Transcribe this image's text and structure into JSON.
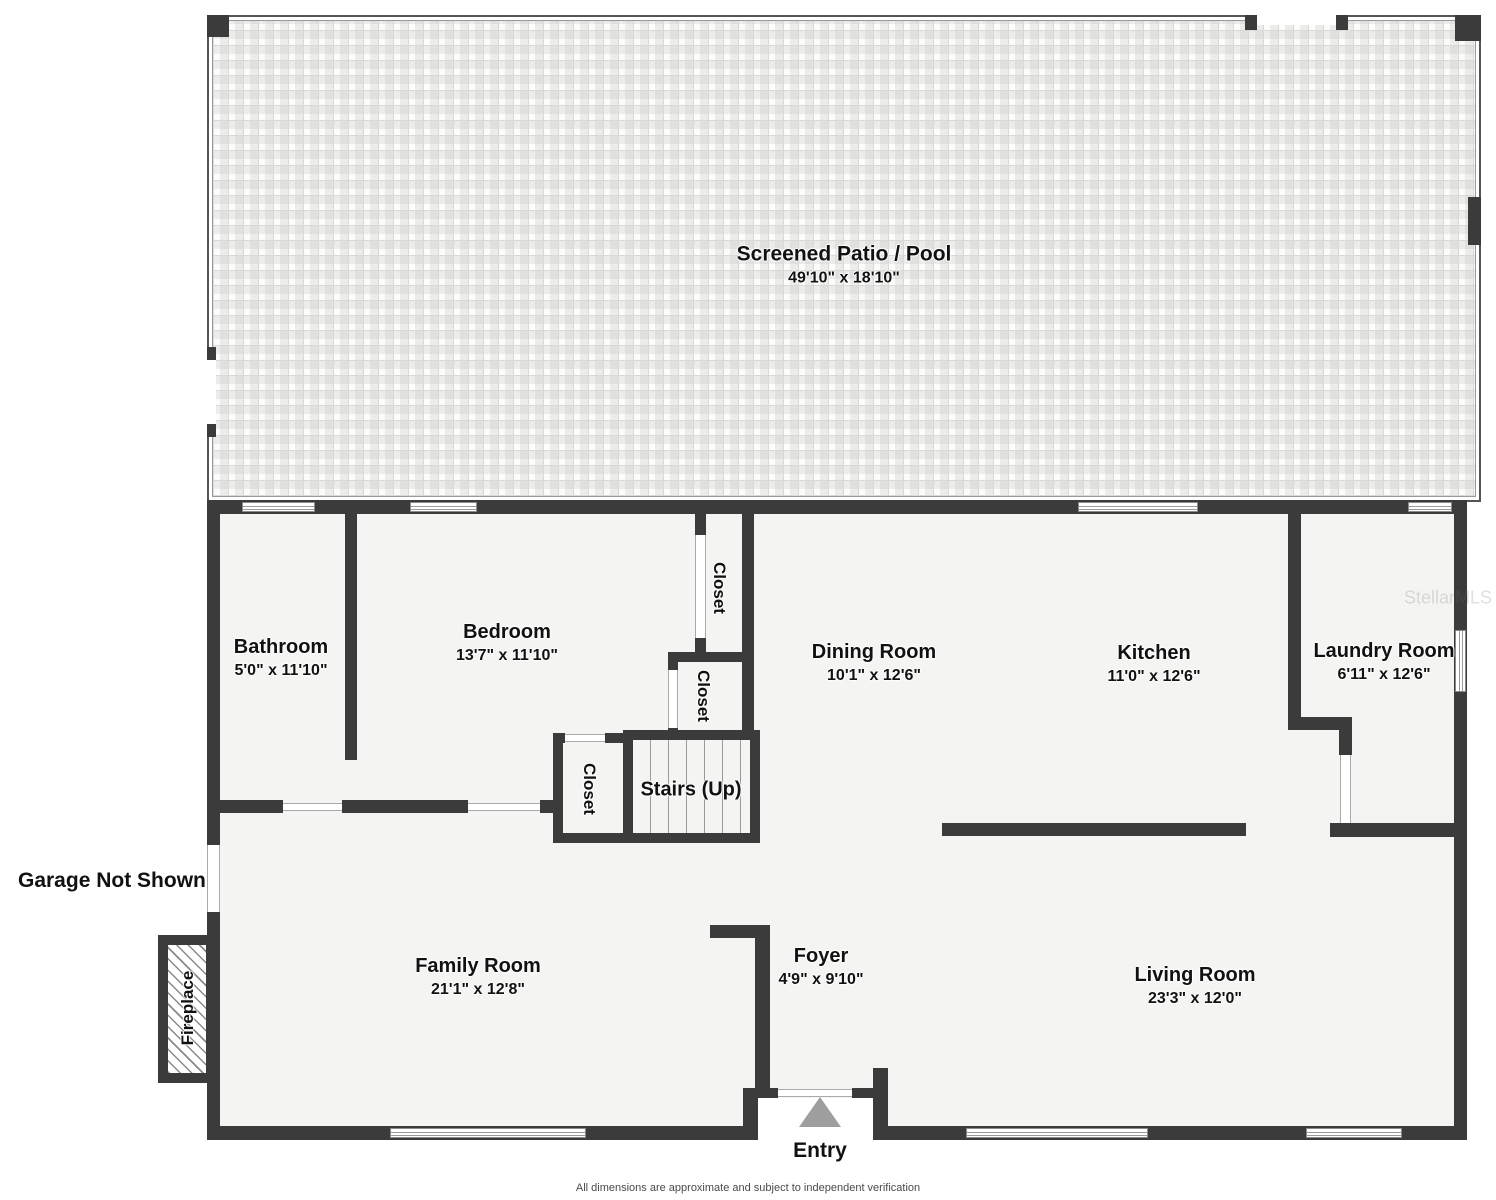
{
  "rooms": {
    "patio": {
      "name": "Screened Patio / Pool",
      "dims": "49'10\" x 18'10\""
    },
    "bathroom": {
      "name": "Bathroom",
      "dims": "5'0\" x 11'10\""
    },
    "bedroom": {
      "name": "Bedroom",
      "dims": "13'7\" x 11'10\""
    },
    "dining": {
      "name": "Dining Room",
      "dims": "10'1\" x 12'6\""
    },
    "kitchen": {
      "name": "Kitchen",
      "dims": "11'0\" x 12'6\""
    },
    "laundry": {
      "name": "Laundry Room",
      "dims": "6'11\" x 12'6\""
    },
    "family": {
      "name": "Family Room",
      "dims": "21'1\" x 12'8\""
    },
    "foyer": {
      "name": "Foyer",
      "dims": "4'9\" x 9'10\""
    },
    "living": {
      "name": "Living Room",
      "dims": "23'3\" x 12'0\""
    },
    "stairs": {
      "name": "Stairs (Up)"
    },
    "closet_bedroom": {
      "name": "Closet"
    },
    "closet_hall": {
      "name": "Closet"
    },
    "closet_stairs": {
      "name": "Closet"
    },
    "fireplace": {
      "name": "Fireplace"
    }
  },
  "annotations": {
    "garage_note": "Garage Not Shown",
    "entry": "Entry",
    "watermark": "StellarMLS",
    "footer": "All dimensions are approximate and subject to independent verification"
  },
  "colors": {
    "wall": "#3b3b3b",
    "floor": "#f4f4f2",
    "entry_arrow": "#9e9e9e"
  }
}
